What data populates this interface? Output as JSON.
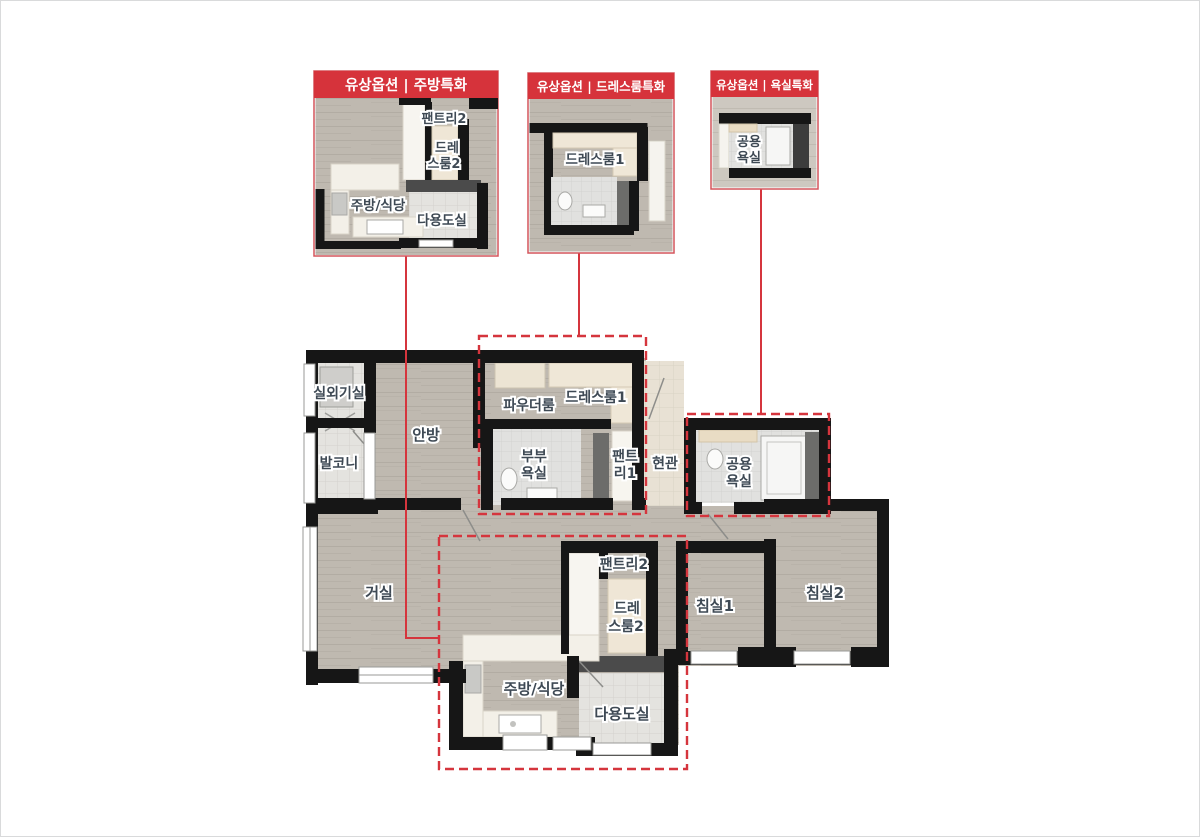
{
  "callouts": [
    {
      "title": "유상옵션 | 주방특화",
      "rooms": {
        "pantry2": "팬트리2",
        "dress2a": "드레",
        "dress2b": "스룸2",
        "kitchen": "주방/식당",
        "utility": "다용도실"
      }
    },
    {
      "title": "유상옵션 | 드레스룸특화",
      "rooms": {
        "dress1": "드레스룸1"
      }
    },
    {
      "title": "유상옵션 | 욕실특화",
      "rooms": {
        "batha": "공용",
        "bathb": "욕실"
      }
    }
  ],
  "plan": {
    "rooms": {
      "outdoor_unit": "실외기실",
      "balcony": "발코니",
      "master": "안방",
      "powder": "파우더룸",
      "dress1": "드레스룸1",
      "mbath_a": "부부",
      "mbath_b": "욕실",
      "pantry1_a": "팬트",
      "pantry1_b": "리1",
      "entrance": "현관",
      "cbath_a": "공용",
      "cbath_b": "욕실",
      "living": "거실",
      "pantry2": "팬트리2",
      "dress2_a": "드레",
      "dress2_b": "스룸2",
      "bed1": "침실1",
      "bed2": "침실2",
      "kitchen": "주방/식당",
      "utility": "다용도실"
    }
  },
  "colors": {
    "accent": "#d5353d",
    "wall": "#161616",
    "floor": "#bfb9b0",
    "label_text": "#3e4954"
  }
}
